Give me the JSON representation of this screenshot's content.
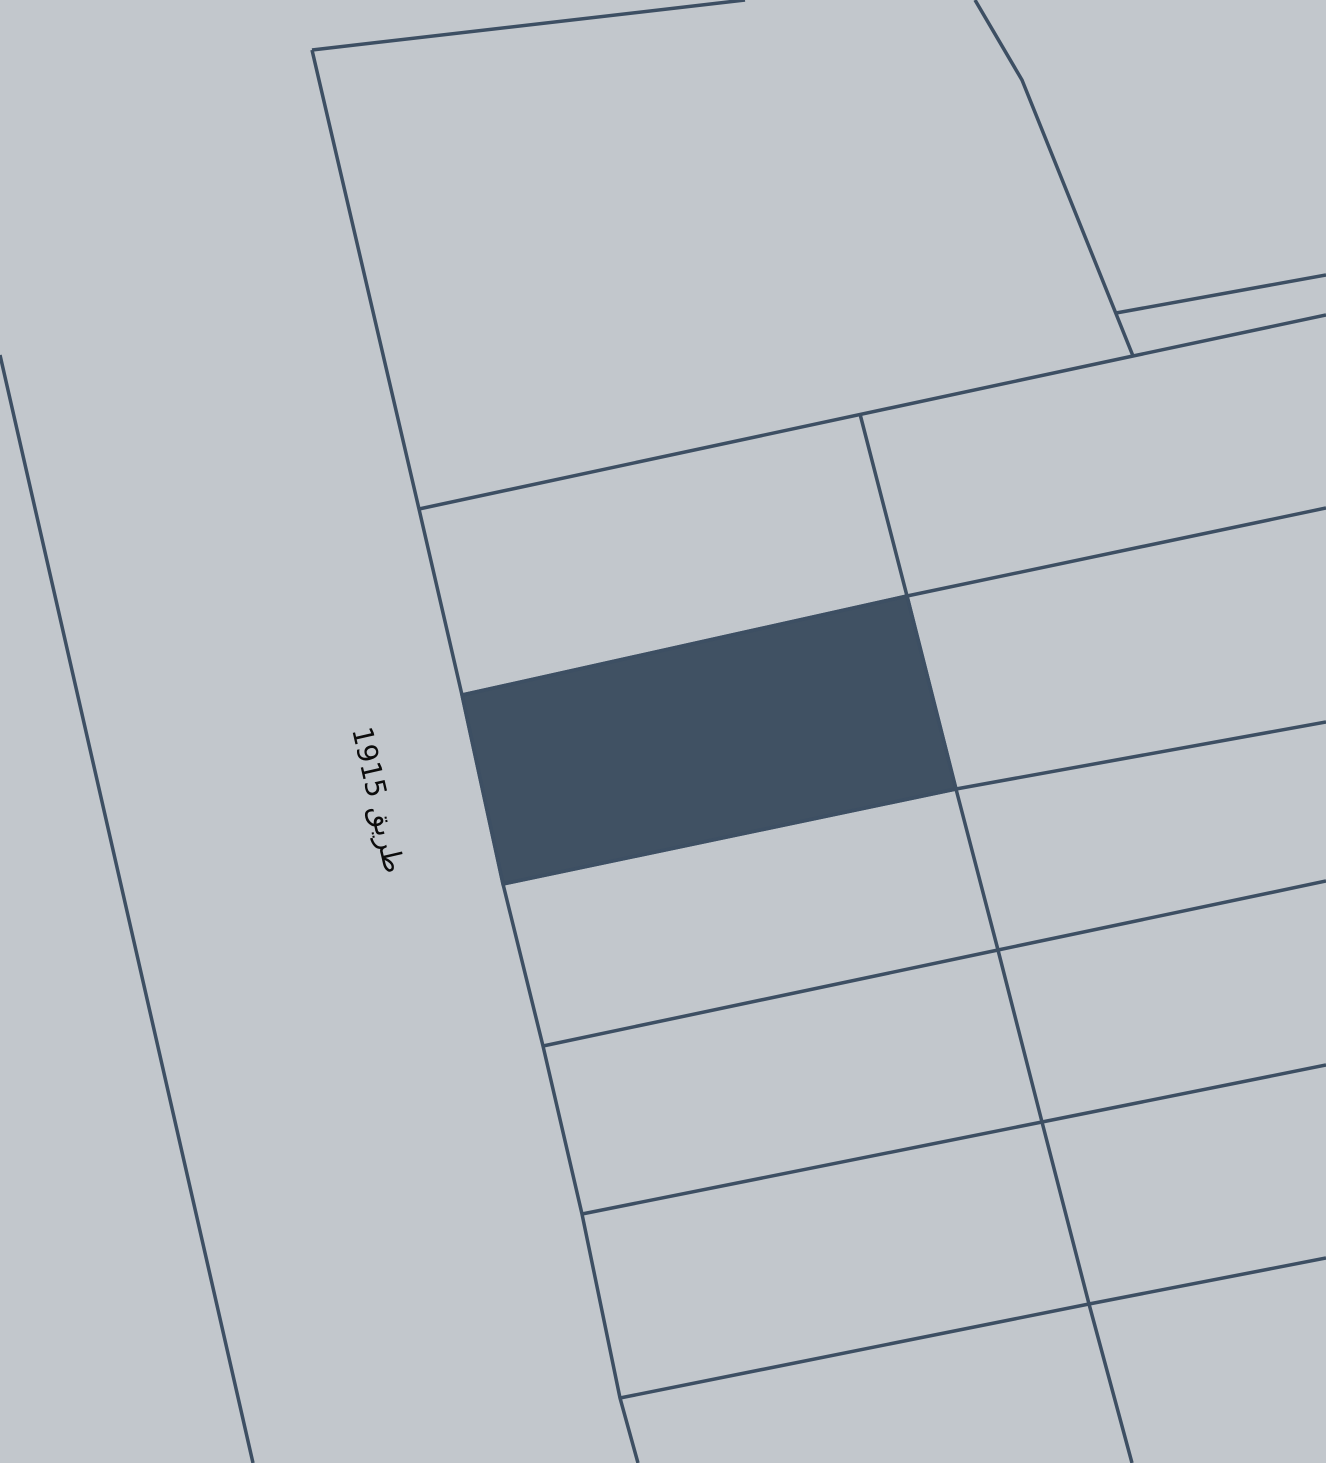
{
  "map": {
    "canvas": {
      "width": 1326,
      "height": 1463
    },
    "background_color": "#c2c7cc",
    "line_color": "#3d4f63",
    "line_width": 3.5,
    "parcel_fill_color": "#405163",
    "road_label": "طريق 1915",
    "label_color": "#0c0c0c",
    "label_style": {
      "x": 378,
      "y": 800,
      "rotation_deg": 77,
      "font_size": 28
    },
    "highlighted_parcel": {
      "name": "selected-parcel",
      "points": [
        [
          462,
          695
        ],
        [
          907,
          596
        ],
        [
          956,
          789
        ],
        [
          503,
          884
        ]
      ]
    },
    "boundary_lines": [
      {
        "name": "road-left-edge",
        "points": [
          [
            0,
            355
          ],
          [
            253,
            1463
          ]
        ]
      },
      {
        "name": "road-right-edge",
        "points": [
          [
            312,
            50
          ],
          [
            419,
            509
          ],
          [
            462,
            695
          ],
          [
            503,
            884
          ],
          [
            543,
            1046
          ],
          [
            582,
            1214
          ],
          [
            620,
            1398
          ],
          [
            638,
            1463
          ]
        ]
      },
      {
        "name": "top-parcel-top-edge",
        "points": [
          [
            312,
            50
          ],
          [
            745,
            0
          ]
        ]
      },
      {
        "name": "top-parcel-right-edge",
        "points": [
          [
            975,
            0
          ],
          [
            1022,
            80
          ],
          [
            1133,
            356
          ]
        ]
      },
      {
        "name": "upper-right-row-line",
        "points": [
          [
            1116,
            313
          ],
          [
            1326,
            275
          ]
        ]
      },
      {
        "name": "main-cross-line",
        "points": [
          [
            419,
            509
          ],
          [
            1133,
            356
          ],
          [
            1326,
            315
          ]
        ]
      },
      {
        "name": "row-line-1",
        "points": [
          [
            462,
            695
          ],
          [
            907,
            596
          ],
          [
            1326,
            508
          ]
        ]
      },
      {
        "name": "row-line-2",
        "points": [
          [
            503,
            884
          ],
          [
            956,
            789
          ],
          [
            1326,
            722
          ]
        ]
      },
      {
        "name": "row-line-3",
        "points": [
          [
            543,
            1046
          ],
          [
            998,
            950
          ],
          [
            1326,
            881
          ]
        ]
      },
      {
        "name": "row-line-4",
        "points": [
          [
            582,
            1214
          ],
          [
            1042,
            1122
          ],
          [
            1326,
            1065
          ]
        ]
      },
      {
        "name": "row-line-5",
        "points": [
          [
            620,
            1398
          ],
          [
            1089,
            1304
          ],
          [
            1326,
            1258
          ]
        ]
      },
      {
        "name": "column-line",
        "points": [
          [
            860,
            414
          ],
          [
            907,
            596
          ],
          [
            956,
            789
          ],
          [
            998,
            950
          ],
          [
            1042,
            1122
          ],
          [
            1089,
            1304
          ],
          [
            1132,
            1463
          ]
        ]
      }
    ]
  }
}
